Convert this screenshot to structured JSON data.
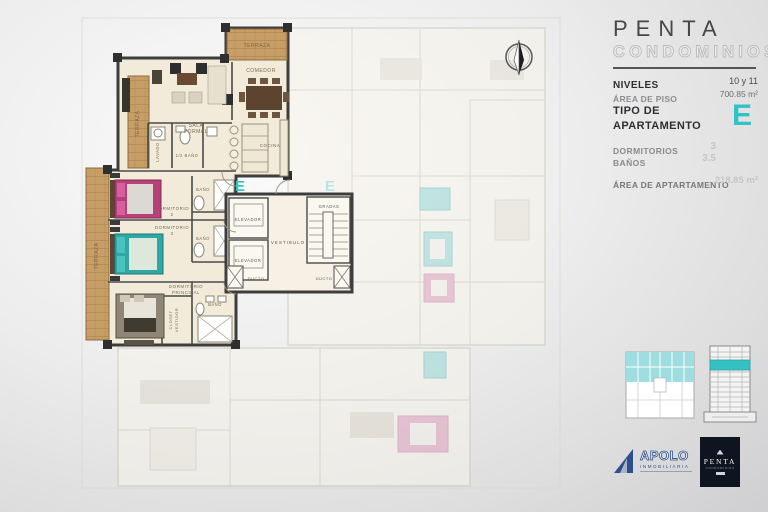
{
  "panel": {
    "brand_line1": "PENTA",
    "brand_line2": "CONDOMINIOS",
    "niveles_label": "NIVELES",
    "niveles_value": "10 y 11",
    "area_piso_label": "ÁREA DE PISO",
    "area_piso_value": "700.85 m²",
    "tipo_label": "TIPO DE APARTAMENTO",
    "tipo_value": "E",
    "dormitorios_label": "DORMITORIOS",
    "dormitorios_value": "3",
    "banos_label": "BAÑOS",
    "banos_value": "3.5",
    "area_apartamento_label": "ÁREA DE APTARTAMENTO",
    "area_apartamento_value": "218.85 m²",
    "accent_color": "#2ec4c6"
  },
  "plan": {
    "unit_letter": "E",
    "ghost_unit_letter": "E",
    "rooms": {
      "terraza_top": "TERRAZA",
      "terraza_left_upper": "TERRAZA",
      "terraza_left_lower": "TERRAZA",
      "comedor": "COMEDOR",
      "sala_formal_l1": "SALA",
      "sala_formal_l2": "FORMAL",
      "lavado": "LAVADO",
      "medio_bano": "1/2 BAÑO",
      "cocina": "COCINA",
      "bano_2": "BAÑO",
      "dormitorio_2_l1": "DORMITORIO",
      "dormitorio_2_l2": "2",
      "dormitorio_3_l1": "DORMITORIO",
      "dormitorio_3_l2": "3",
      "bano_3": "BAÑO",
      "dormitorio_principal_l1": "DORMITORIO",
      "dormitorio_principal_l2": "PRINCIPAL",
      "closet_l1": "CLOSET",
      "closet_l2": "VESTIDOR",
      "bano_principal": "BAÑO",
      "elevador_1": "ELEVADOR",
      "elevador_2": "ELEVADOR",
      "vestibulo": "VESTIBULO",
      "gradas": "GRADAS",
      "ducto_left": "DUCTO",
      "ducto_right": "DUCTO"
    },
    "colors": {
      "wall": "#3d3d3d",
      "floor": "#f2ebd9",
      "wood": "#c79e66",
      "bed_pink": "#b8407a",
      "bed_teal": "#2fa8a4"
    }
  },
  "logos": {
    "apolo_name": "APOLO",
    "apolo_sub": "INMOBILIARIA",
    "penta_name": "PENTA",
    "penta_sub": "CONDOMINIOS"
  }
}
